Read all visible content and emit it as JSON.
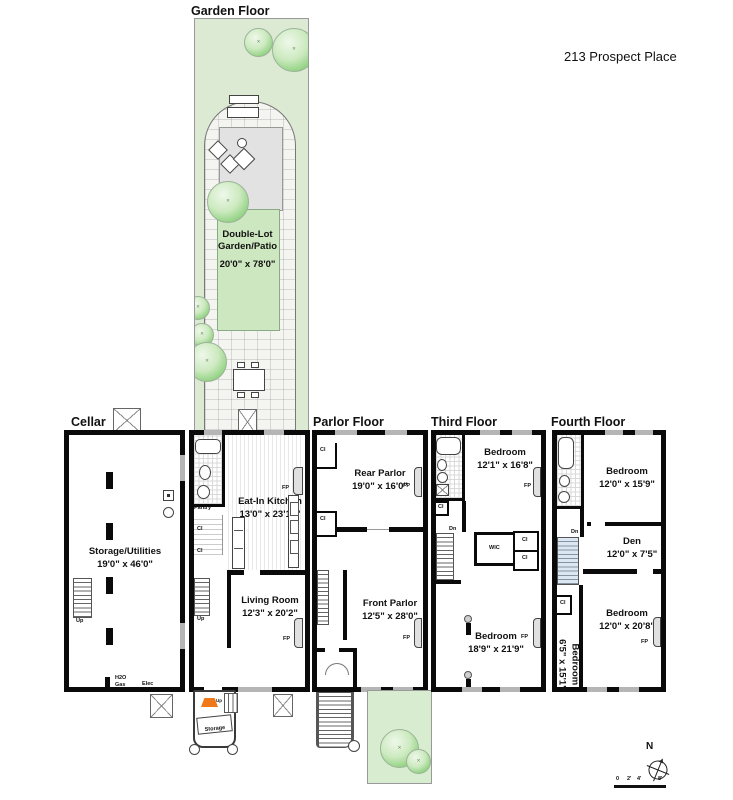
{
  "title": "213 Prospect Place",
  "floor_labels": {
    "garden": "Garden Floor",
    "cellar": "Cellar",
    "parlor": "Parlor Floor",
    "third": "Third Floor",
    "fourth": "Fourth Floor"
  },
  "rooms": {
    "garden_patio": {
      "name": "Double-Lot Garden/Patio",
      "dims": "20'0\" x 78'0\""
    },
    "storage_utilities": {
      "name": "Storage/Utilities",
      "dims": "19'0\" x 46'0\""
    },
    "kitchen": {
      "name": "Eat-In Kitchen",
      "dims": "13'0\" x 23'10\""
    },
    "living_room": {
      "name": "Living Room",
      "dims": "12'3\" x 20'2\""
    },
    "rear_parlor": {
      "name": "Rear Parlor",
      "dims": "19'0\" x 16'0\""
    },
    "front_parlor": {
      "name": "Front Parlor",
      "dims": "12'5\" x 28'0\""
    },
    "bedroom_third_rear": {
      "name": "Bedroom",
      "dims": "12'1\" x 16'8\""
    },
    "bedroom_third_front": {
      "name": "Bedroom",
      "dims": "18'9\" x 21'9\""
    },
    "bedroom_fourth_rear": {
      "name": "Bedroom",
      "dims": "12'0\" x 15'9\""
    },
    "den": {
      "name": "Den",
      "dims": "12'0\" x 7'5\""
    },
    "bedroom_fourth_front": {
      "name": "Bedroom",
      "dims": "12'0\" x 20'8\""
    },
    "bedroom_fourth_side": {
      "name": "Bedroom",
      "dims": "6'5\" x 15'1\""
    }
  },
  "small_labels": {
    "pantry": "Pantry",
    "storage": "Storage",
    "wic": "WIC",
    "cl": "Cl",
    "fp": "FP",
    "up": "Up",
    "dn": "Dn",
    "h2o": "H2O",
    "gas": "Gas",
    "elec": "Elec"
  },
  "compass": {
    "north": "N"
  },
  "scale_bar": {
    "ticks": [
      "0",
      "2'",
      "4'",
      "8'"
    ]
  },
  "colors": {
    "garden_green": "#dcead3",
    "lawn_green": "#cde7c0",
    "tree_green": "#8fd180",
    "patio_gray": "#e2e2e2",
    "wall_black": "#0a0a0a",
    "awning_orange": "#f07818",
    "skylight_blue": "#cfe4f0"
  }
}
